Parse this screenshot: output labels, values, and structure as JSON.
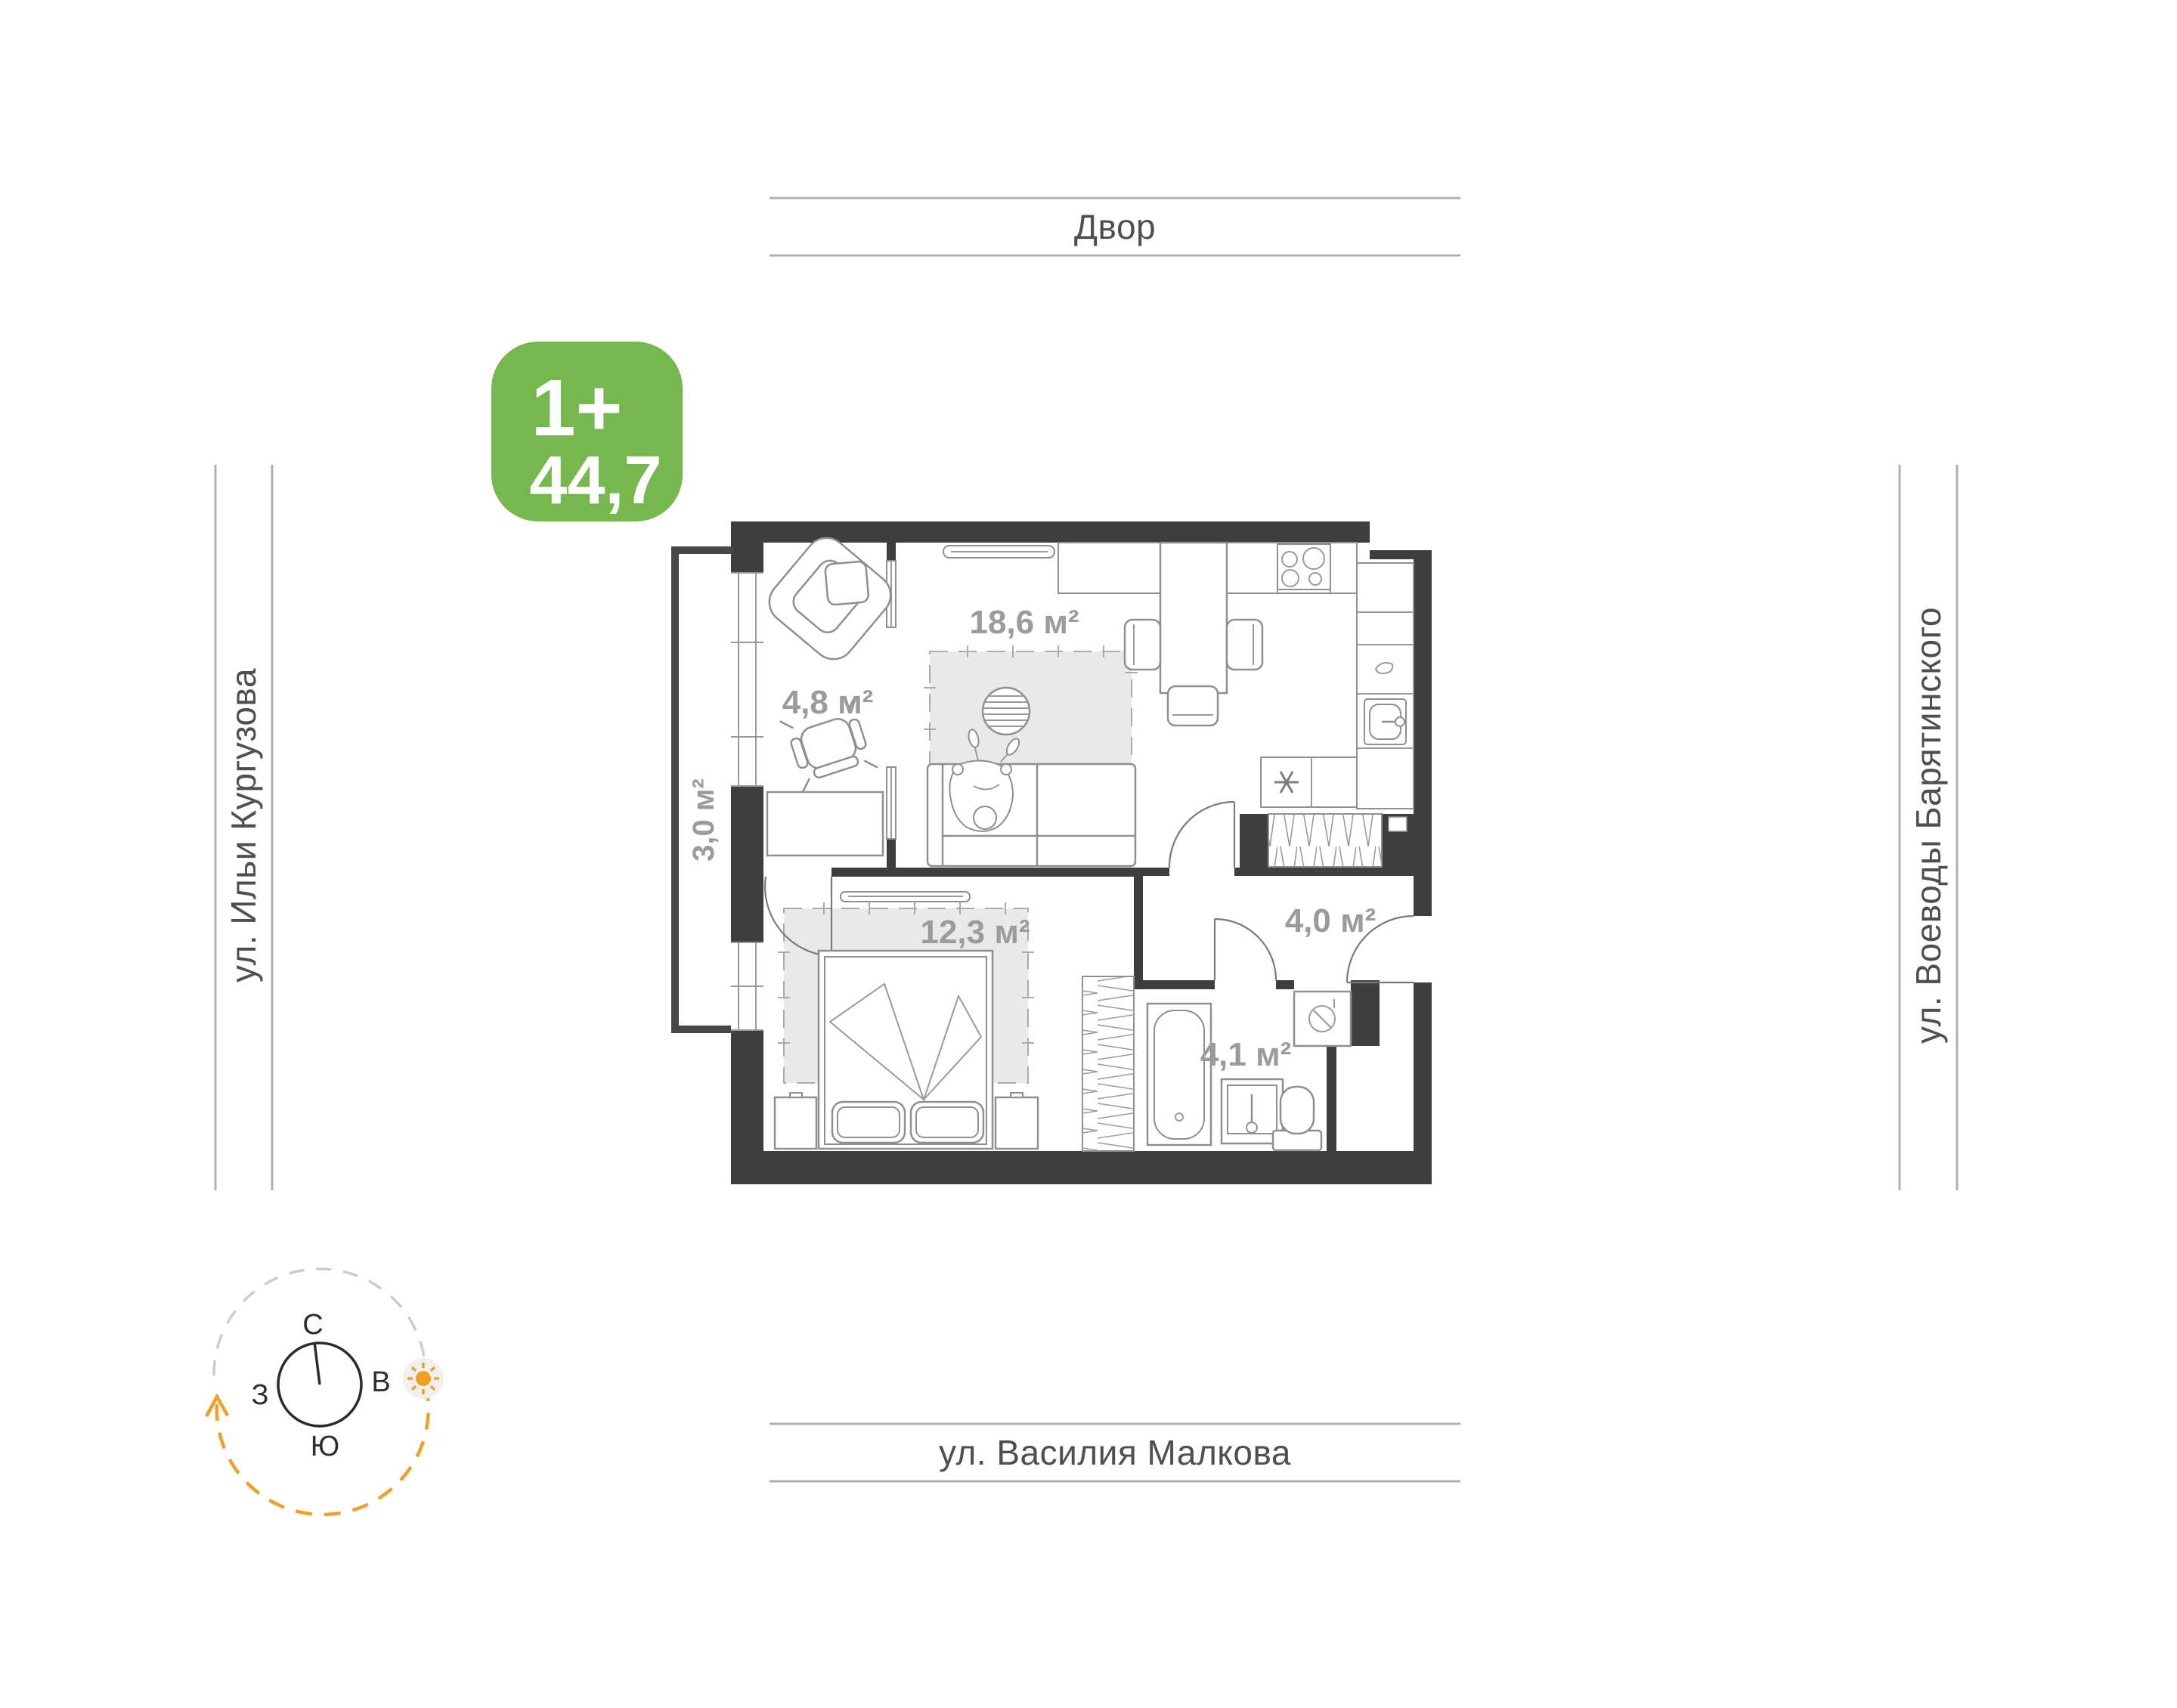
{
  "badge": {
    "room_type": "1+",
    "total_area": "44,7",
    "color": "#76b84e"
  },
  "streets": {
    "top": "Двор",
    "left": "ул. Ильи Кургузова",
    "right": "ул. Воеводы Барятинского",
    "bottom": "ул. Василия Малкова"
  },
  "rooms": {
    "living_kitchen": {
      "label": "living-kitchen",
      "area": "18,6 м²"
    },
    "study": {
      "label": "study",
      "area": "4,8 м²"
    },
    "balcony": {
      "label": "balcony",
      "area": "3,0 м²"
    },
    "bedroom": {
      "label": "bedroom",
      "area": "12,3 м²"
    },
    "hallway": {
      "label": "hallway",
      "area": "4,0 м²"
    },
    "bathroom": {
      "label": "bathroom",
      "area": "4,1 м²"
    }
  },
  "compass": {
    "north": "С",
    "east": "В",
    "west": "З",
    "south": "Ю"
  },
  "colors": {
    "wall": "#3e3e3e",
    "furniture_line": "#8f8f8f",
    "rug_fill": "#e9e9e9",
    "street_line": "#b0b0b0",
    "street_text": "#4f4f4f",
    "area_text": "#9b9b9b",
    "badge_green": "#76b84e",
    "sun_orange": "#f2a024"
  }
}
